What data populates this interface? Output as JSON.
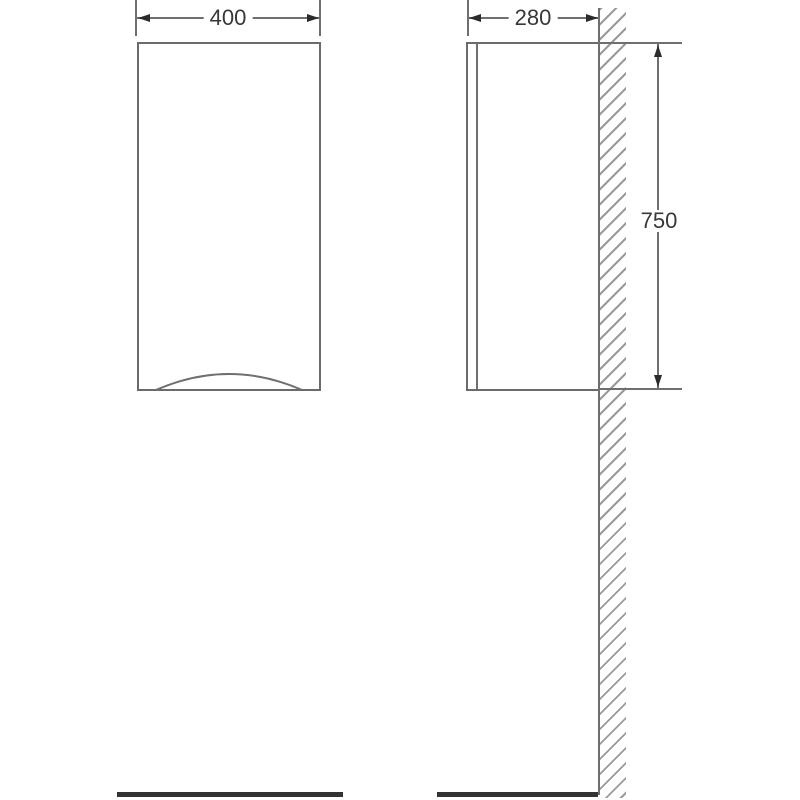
{
  "document": {
    "type": "technical-drawing",
    "subject": "wall-hung cabinet, front and side elevation views"
  },
  "dimensions": {
    "width": {
      "label": "400",
      "applies_to": "front view overall width"
    },
    "depth": {
      "label": "280",
      "applies_to": "side view overall depth"
    },
    "height": {
      "label": "750",
      "applies_to": "side view overall height"
    }
  },
  "colors": {
    "background": "#ffffff",
    "thin_line": "#6f6f6f",
    "outline": "#6b6b6b",
    "arrow_and_text": "#2b2b2b",
    "hatch": "#9a9a9a",
    "floor_bar": "#333333"
  }
}
